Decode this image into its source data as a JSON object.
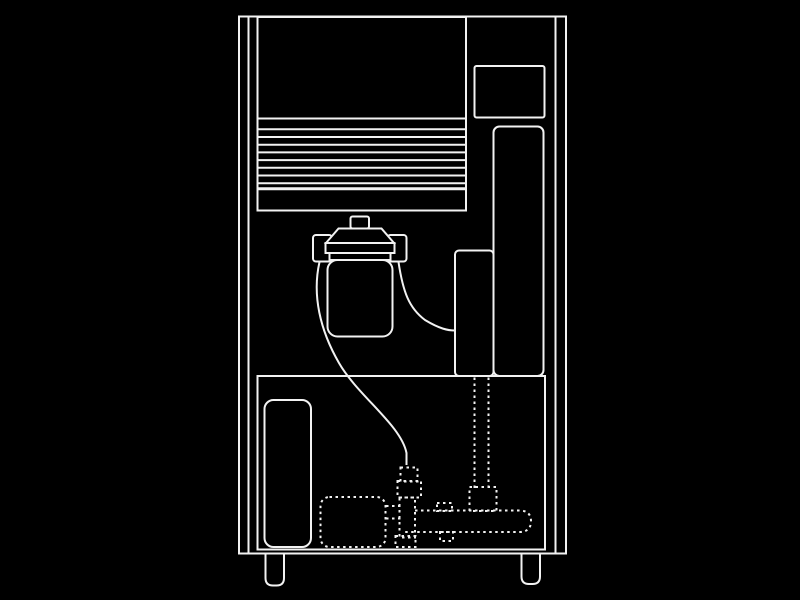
{
  "canvas": {
    "width": 800,
    "height": 600,
    "background_color": "#000000",
    "line_color": "#f2f2f2"
  },
  "diagram": {
    "type": "technical-line-drawing",
    "subject": "appliance water-filter plumbing schematic (front view of cabinet-style machine, e.g. ice machine)",
    "style": "white outline line art on black; internal water lines drawn dotted",
    "components": [
      {
        "name": "cabinet-outline",
        "stroke": "solid"
      },
      {
        "name": "left-side-panel-line",
        "stroke": "solid"
      },
      {
        "name": "right-side-panel-line",
        "stroke": "solid"
      },
      {
        "name": "front-louver-panel",
        "stroke": "solid"
      },
      {
        "name": "louver-slats",
        "stroke": "solid",
        "count": 8
      },
      {
        "name": "top-right-control-box",
        "stroke": "solid"
      },
      {
        "name": "right-column-panel",
        "stroke": "solid"
      },
      {
        "name": "reservoir-box",
        "stroke": "solid"
      },
      {
        "name": "compartment-divider",
        "stroke": "solid"
      },
      {
        "name": "lower-compartment",
        "stroke": "solid"
      },
      {
        "name": "bottom-left-panel",
        "stroke": "solid"
      },
      {
        "name": "left-foot",
        "stroke": "solid"
      },
      {
        "name": "right-foot",
        "stroke": "solid"
      },
      {
        "name": "water-filter-knob",
        "stroke": "solid"
      },
      {
        "name": "water-filter-head",
        "stroke": "solid"
      },
      {
        "name": "water-filter-collar",
        "stroke": "solid"
      },
      {
        "name": "water-filter-body",
        "stroke": "solid"
      },
      {
        "name": "water-filter-inlet-port",
        "stroke": "solid"
      },
      {
        "name": "water-filter-outlet-port",
        "stroke": "solid"
      },
      {
        "name": "filter-inlet-tube",
        "stroke": "solid"
      },
      {
        "name": "filter-outlet-tube",
        "stroke": "solid"
      },
      {
        "name": "pump-box",
        "stroke": "dashed"
      },
      {
        "name": "pump-coupling-lines",
        "stroke": "dashed"
      },
      {
        "name": "tube-compression-nut",
        "stroke": "dashed"
      },
      {
        "name": "inlet-valve-body",
        "stroke": "dashed"
      },
      {
        "name": "valve-elbow",
        "stroke": "dashed"
      },
      {
        "name": "valve-drain-stubs",
        "stroke": "dashed"
      },
      {
        "name": "water-manifold-pipe",
        "stroke": "dashed"
      },
      {
        "name": "manifold-top-bump",
        "stroke": "dashed"
      },
      {
        "name": "tee-fitting",
        "stroke": "dashed"
      },
      {
        "name": "reservoir-down-pipe",
        "stroke": "dashed",
        "count": 2
      }
    ]
  }
}
